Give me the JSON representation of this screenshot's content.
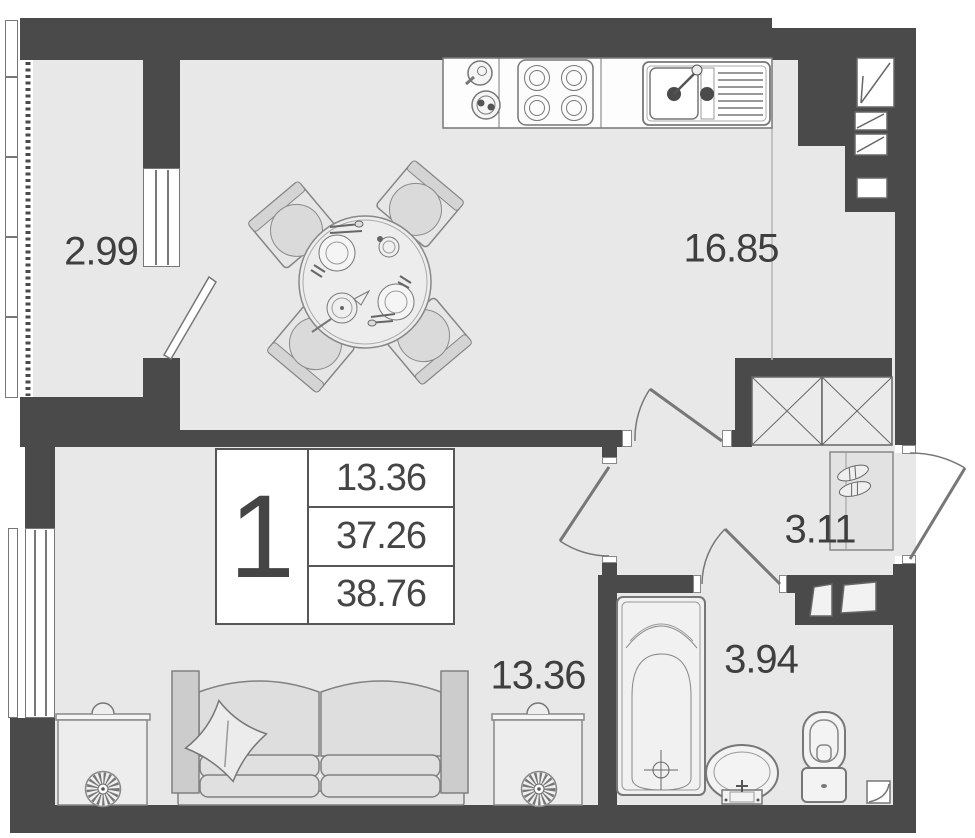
{
  "floor_plan": {
    "stamp": {
      "rooms_count": "1",
      "line1": "13.36",
      "line2": "37.26",
      "line3": "38.76"
    },
    "room_labels": {
      "balcony": "2.99",
      "kitchen_living": "16.85",
      "hallway": "3.11",
      "bedroom": "13.36",
      "bathroom": "3.94"
    },
    "colors": {
      "wall": "#4a4a4a",
      "floor": "#e8e8e8",
      "outline": "#777777",
      "label_text": "#3f3f3f"
    },
    "furniture_icons": [
      "dining-table-icon",
      "dining-chair-icon",
      "stove-icon",
      "kitchen-sink-icon",
      "kettle-icon",
      "pot-icon",
      "sofa-icon",
      "pillow-icon",
      "nightstand-icon",
      "plant-icon",
      "bathtub-icon",
      "washbasin-icon",
      "toilet-icon",
      "shoe-cabinet-icon",
      "shoes-icon",
      "door-swing-icon",
      "vent-shaft-icon",
      "wardrobe-shaft-icon",
      "window-icon"
    ]
  }
}
